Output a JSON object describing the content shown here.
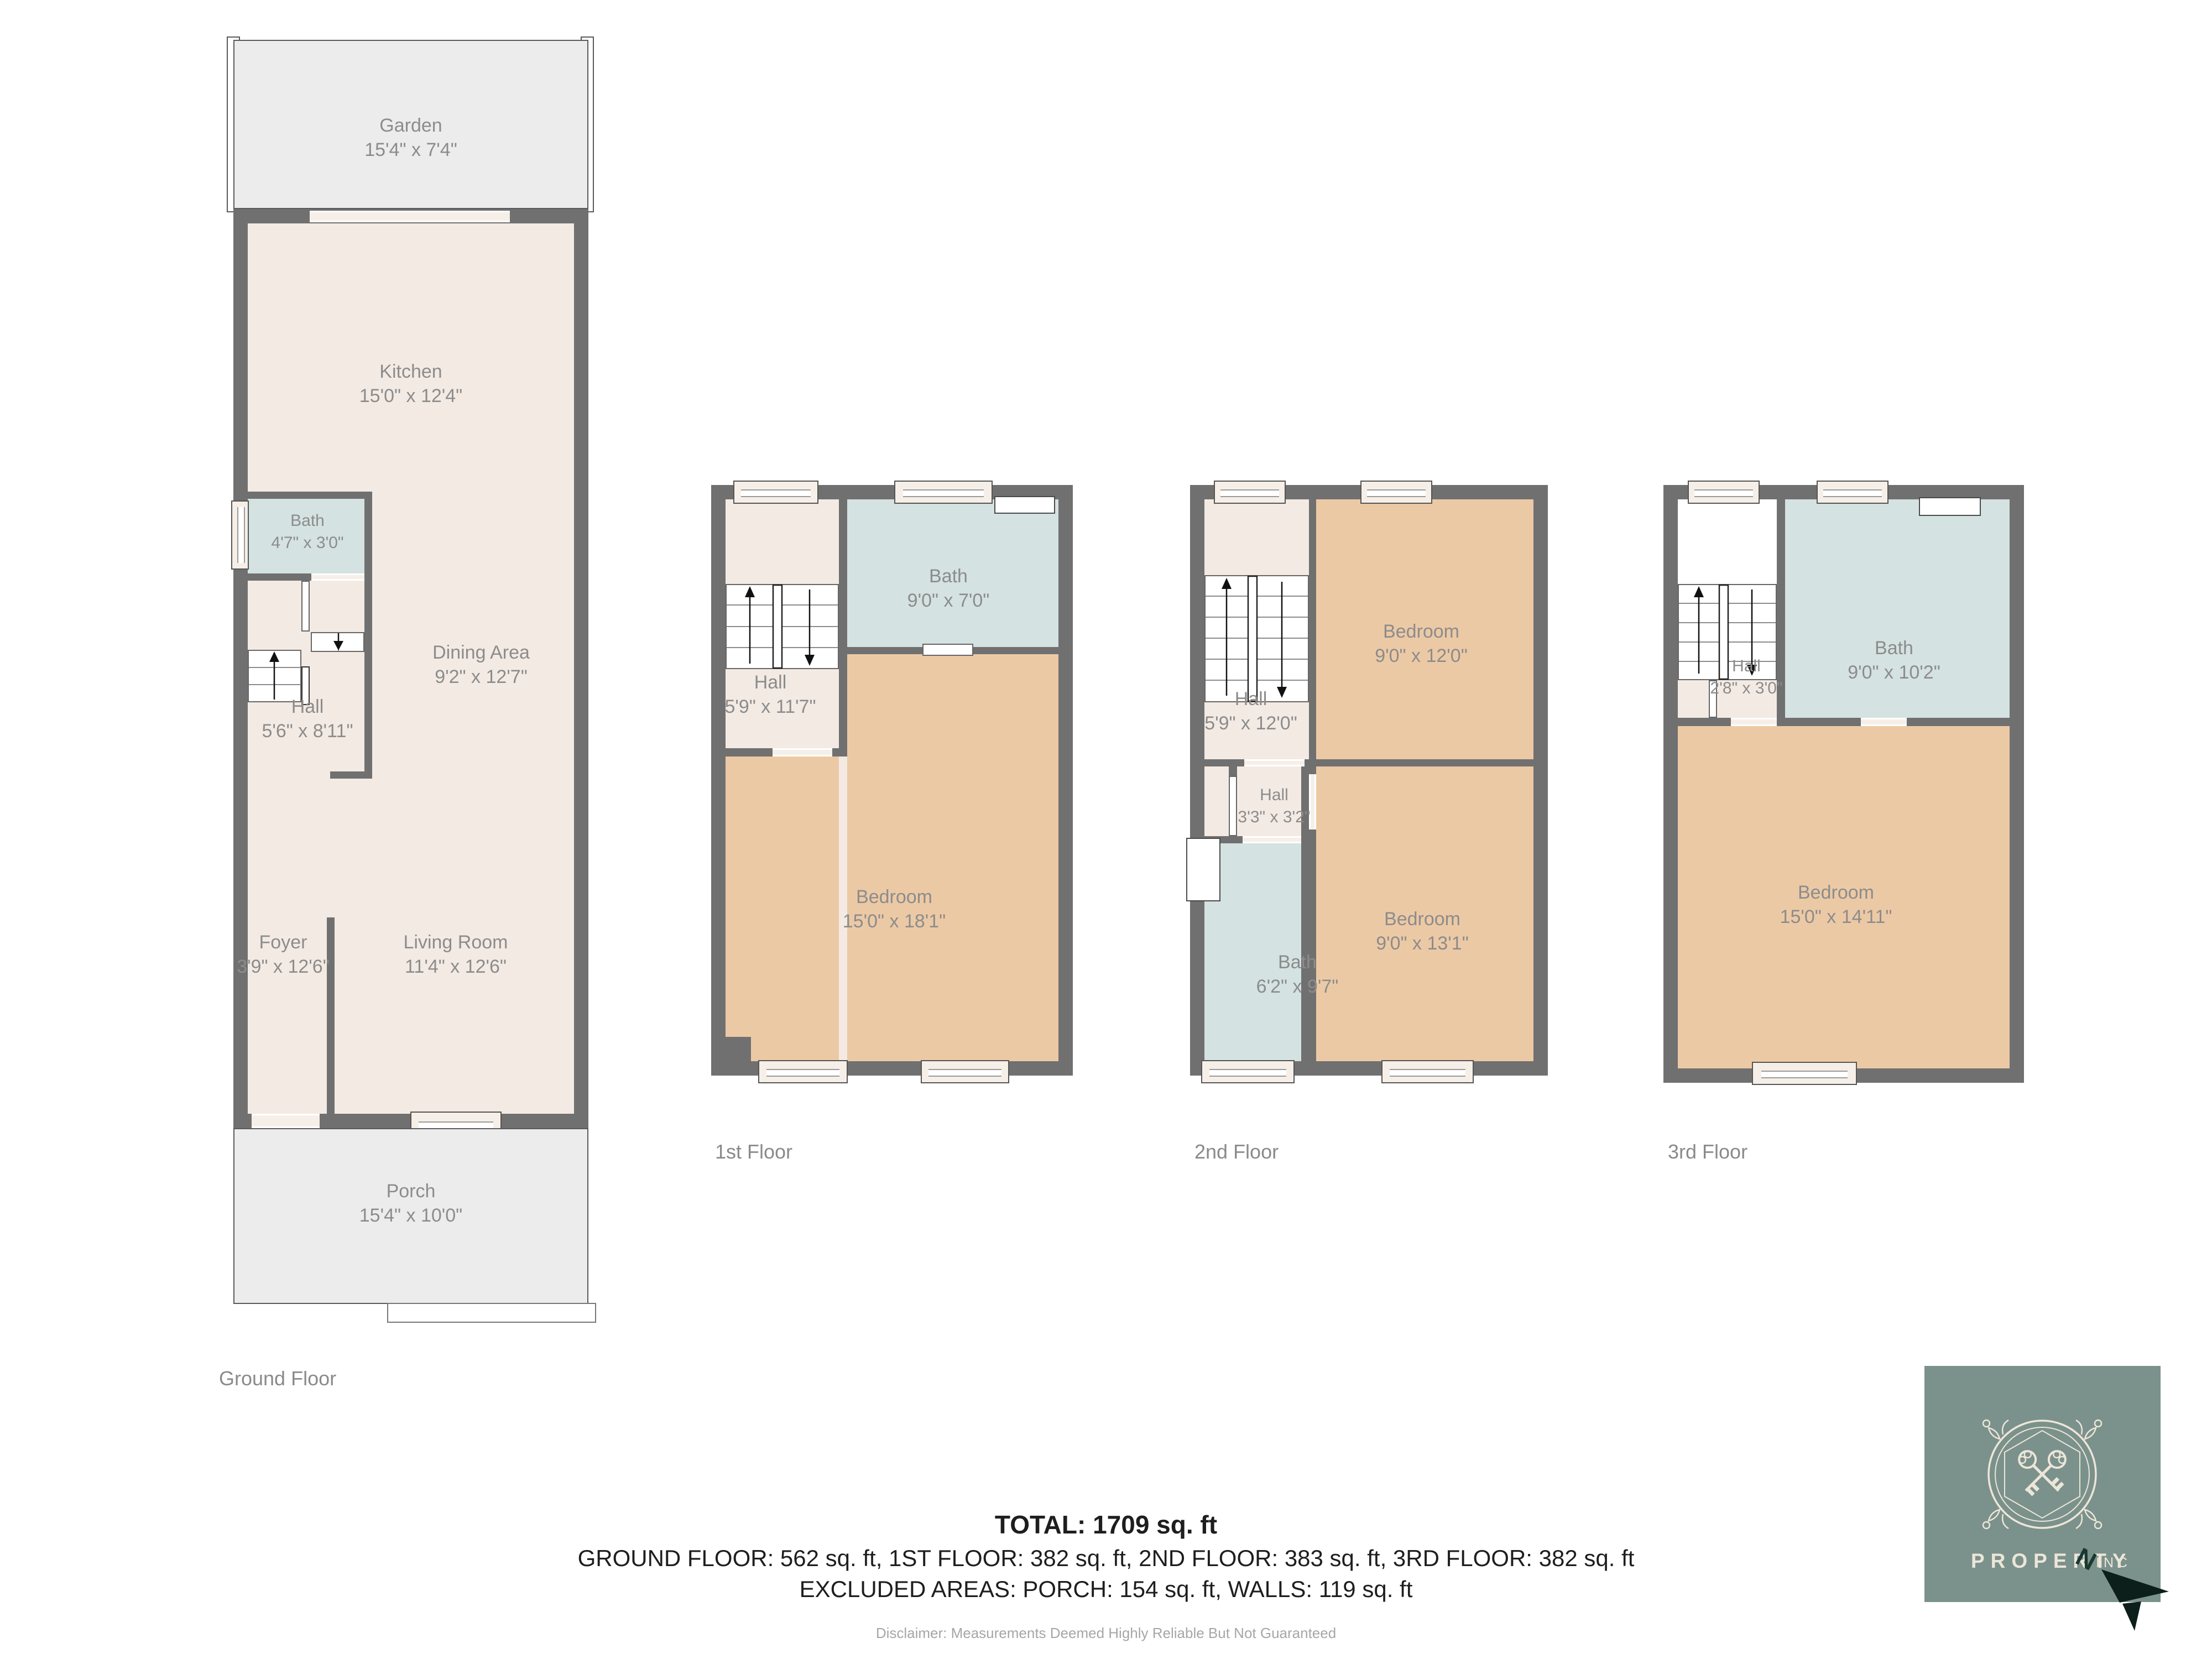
{
  "floors": {
    "ground": {
      "caption": "Ground Floor",
      "rooms": {
        "garden": {
          "name": "Garden",
          "dims": "15'4\" x 7'4\""
        },
        "kitchen": {
          "name": "Kitchen",
          "dims": "15'0\" x 12'4\""
        },
        "bath": {
          "name": "Bath",
          "dims": "4'7\" x 3'0\""
        },
        "hall": {
          "name": "Hall",
          "dims": "5'6\" x 8'11\""
        },
        "dining": {
          "name": "Dining Area",
          "dims": "9'2\" x 12'7\""
        },
        "foyer": {
          "name": "Foyer",
          "dims": "3'9\" x 12'6\""
        },
        "living": {
          "name": "Living Room",
          "dims": "11'4\" x 12'6\""
        },
        "porch": {
          "name": "Porch",
          "dims": "15'4\" x 10'0\""
        }
      }
    },
    "first": {
      "caption": "1st Floor",
      "rooms": {
        "bath": {
          "name": "Bath",
          "dims": "9'0\" x 7'0\""
        },
        "hall": {
          "name": "Hall",
          "dims": "5'9\" x 11'7\""
        },
        "bedroom": {
          "name": "Bedroom",
          "dims": "15'0\" x 18'1\""
        }
      }
    },
    "second": {
      "caption": "2nd Floor",
      "rooms": {
        "hall_upper": {
          "name": "Hall",
          "dims": "5'9\" x 12'0\""
        },
        "bedroom_top": {
          "name": "Bedroom",
          "dims": "9'0\" x 12'0\""
        },
        "hall_small": {
          "name": "Hall",
          "dims": "3'3\" x 3'2\""
        },
        "bath": {
          "name": "Bath",
          "dims": "6'2\" x 9'7\""
        },
        "bedroom_bottom": {
          "name": "Bedroom",
          "dims": "9'0\" x 13'1\""
        }
      }
    },
    "third": {
      "caption": "3rd Floor",
      "rooms": {
        "bath": {
          "name": "Bath",
          "dims": "9'0\" x 10'2\""
        },
        "hall": {
          "name": "Hall",
          "dims": "2'8\" x 3'0\""
        },
        "bedroom": {
          "name": "Bedroom",
          "dims": "15'0\" x 14'11\""
        }
      }
    }
  },
  "summary": {
    "total": "TOTAL: 1709 sq. ft",
    "floors_line": "GROUND FLOOR: 562 sq. ft, 1ST FLOOR: 382 sq. ft, 2ND FLOOR: 383 sq. ft, 3RD FLOOR: 382 sq. ft",
    "excluded_line": "EXCLUDED AREAS: PORCH: 154 sq. ft, WALLS: 119 sq. ft",
    "disclaimer": "Disclaimer: Measurements Deemed Highly Reliable But Not Guaranteed"
  },
  "logo": {
    "brand": "PROPERTY",
    "compass_letter": "N",
    "suffix": "INC"
  },
  "colors": {
    "wall": "#707070",
    "room_cream": "#f3eae3",
    "bath_blue": "#d4e2e1",
    "bedroom_tan": "#ecc9a5",
    "outdoor_gray": "#ececec",
    "label_gray": "#8c8c8c",
    "logo_green": "#7b918c",
    "logo_cream": "#ece6d8",
    "compass_dark": "#0c1f1a"
  }
}
